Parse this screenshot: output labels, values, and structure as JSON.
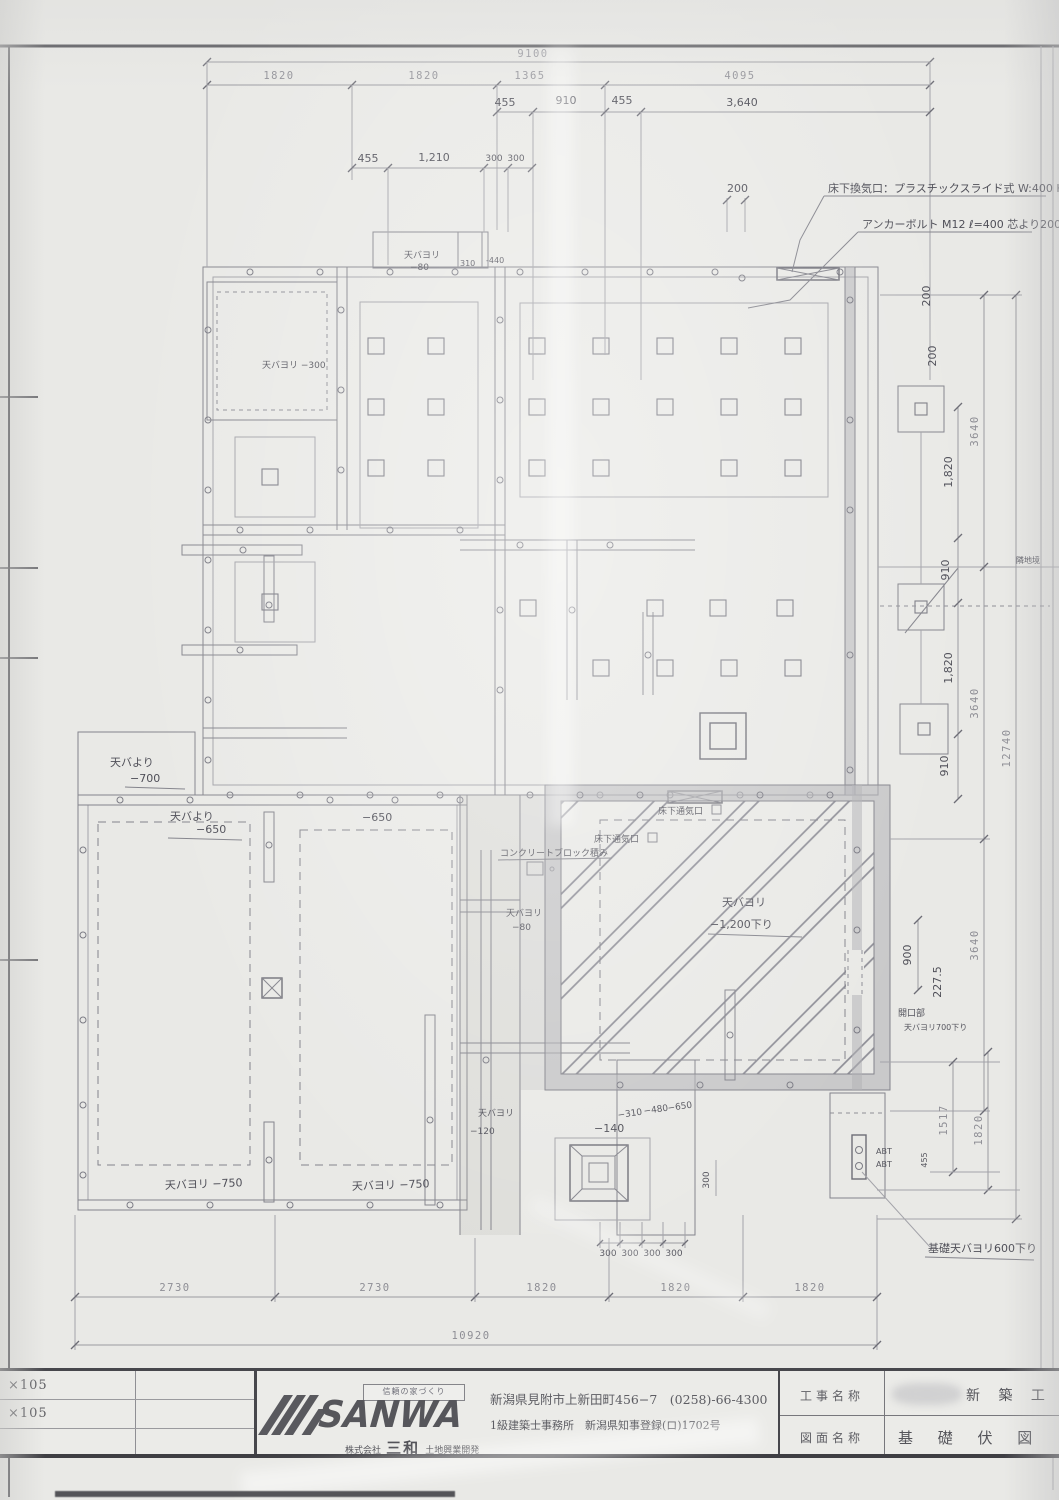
{
  "sheet": {
    "left_margin_note_1": "×105",
    "left_margin_note_2": "×105"
  },
  "title_block": {
    "tagline": "信頼の家づくり",
    "logo_text": "SANWA",
    "company_prefix": "株式会社",
    "company_main": "三和",
    "company_suffix": "土地興業開発",
    "address_line": "新潟県見附市上新田町456−7　(0258)-66-4300",
    "license_line": "1級建築士事務所　新潟県知事登録(ロ)1702号",
    "project_label": "工事名称",
    "project_value": "新 築 工",
    "drawing_label": "図面名称",
    "drawing_value": "基 礎 伏 図"
  },
  "dims": {
    "top_overall": "9100",
    "top_1820a": "1820",
    "top_1820b": "1820",
    "top_1365": "1365",
    "top_4095": "4095",
    "h455a": "455",
    "h910a": "910",
    "h455b": "455",
    "h3640": "3,640",
    "h455c": "455",
    "h1210": "1,210",
    "h300a": "300",
    "h300b": "300",
    "h200": "200",
    "h310": "310",
    "h440": "-440",
    "right_3640a": "3640",
    "right_3640b": "3640",
    "right_3640c": "3640",
    "right_overall": "12740",
    "right_1517": "1517",
    "right_1820": "1820",
    "hr1820a": "1,820",
    "hr910a": "910",
    "hr1820b": "1,820",
    "hr910b": "910",
    "h900": "900",
    "h2275": "227.5",
    "h455d": "455",
    "bot_2730a": "2730",
    "bot_2730b": "2730",
    "bot_1820a": "1820",
    "bot_1820b": "1820",
    "bot_1820c": "1820",
    "bot_overall": "10920",
    "pit300": [
      "300",
      "300",
      "300",
      "300"
    ],
    "pit300side": "300"
  },
  "annotations": {
    "vent_note": "床下換気口：プラスチックスライド式 W:400 H:200",
    "anchor_note": "アンカーボルト M12 ℓ=400 芯より200通り",
    "tenba_300": "天バヨリ −300",
    "tenba_80_top_1": "天バヨリ",
    "tenba_80_top_2": "−80",
    "tenba_700_1": "天バより",
    "tenba_700_2": "−700",
    "tenba_650_1": "天バより",
    "tenba_650_2": "−650",
    "minus_650": "−650",
    "block_note": "コンクリートブロック積み",
    "vent_a": "床下通気口",
    "vent_b": "床下通気口",
    "tenba_80_mid_1": "天バヨリ",
    "tenba_80_mid_2": "−80",
    "tenba_1200_1": "天バヨリ",
    "tenba_1200_2": "−1,200下り",
    "opening_1": "開口部",
    "opening_2": "天バヨリ700下り",
    "tenba_750_a": "天バヨリ −750",
    "tenba_750_b": "天バヨリ −750",
    "tenba_120_1": "天バヨリ",
    "tenba_120_2": "−120",
    "minus_140": "−140",
    "minus_310": "−310",
    "minus_480": "−480",
    "minus_650b": "−650",
    "foundation_600": "基礎天バヨリ600下り",
    "abt_1": "ABT",
    "abt_2": "ABT",
    "edge_note": "隣地境"
  }
}
